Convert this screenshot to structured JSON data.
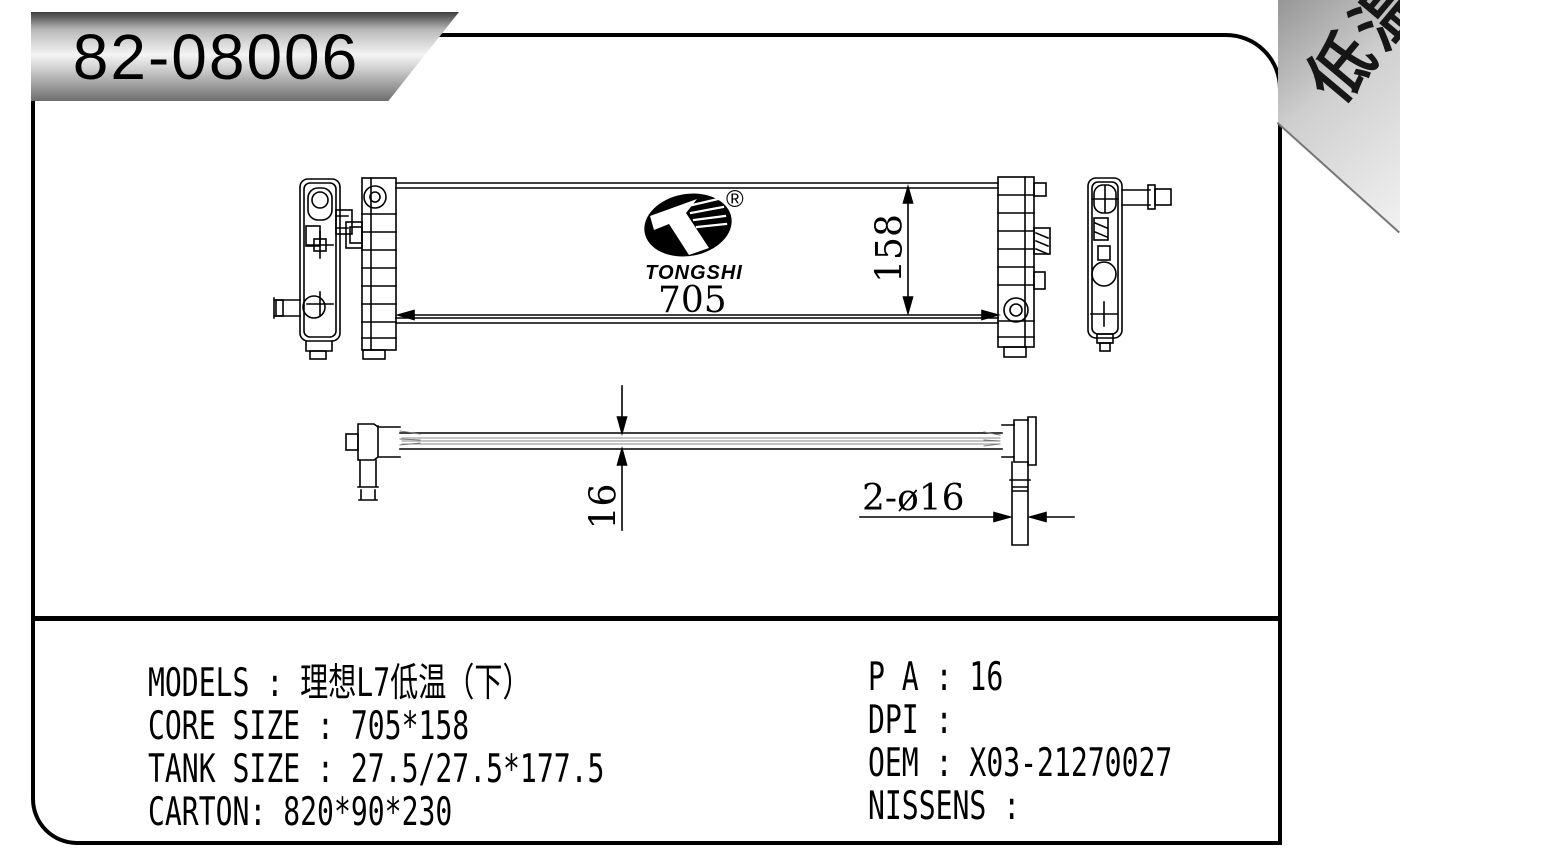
{
  "badge": {
    "part_number": "82-08006"
  },
  "corner_ribbon": {
    "label": "低温"
  },
  "logo": {
    "brand": "TONGSHI",
    "registered_mark": "®"
  },
  "drawing": {
    "dim_core_width": "705",
    "dim_core_height": "158",
    "dim_thickness": "16",
    "dim_pipe_note": "2-ø16"
  },
  "specs": {
    "left_lines": [
      "MODELS : 理想L7低温（下）",
      "CORE SIZE : 705*158",
      "TANK SIZE : 27.5/27.5*177.5",
      "CARTON: 820*90*230"
    ],
    "right_lines": [
      "P A : 16",
      "DPI :",
      "OEM : X03-21270027",
      "NISSENS :"
    ]
  },
  "colors": {
    "line": "#000000",
    "badge_highlight": "#f4f4f4",
    "ribbon_gray": "#bdbdbd"
  }
}
